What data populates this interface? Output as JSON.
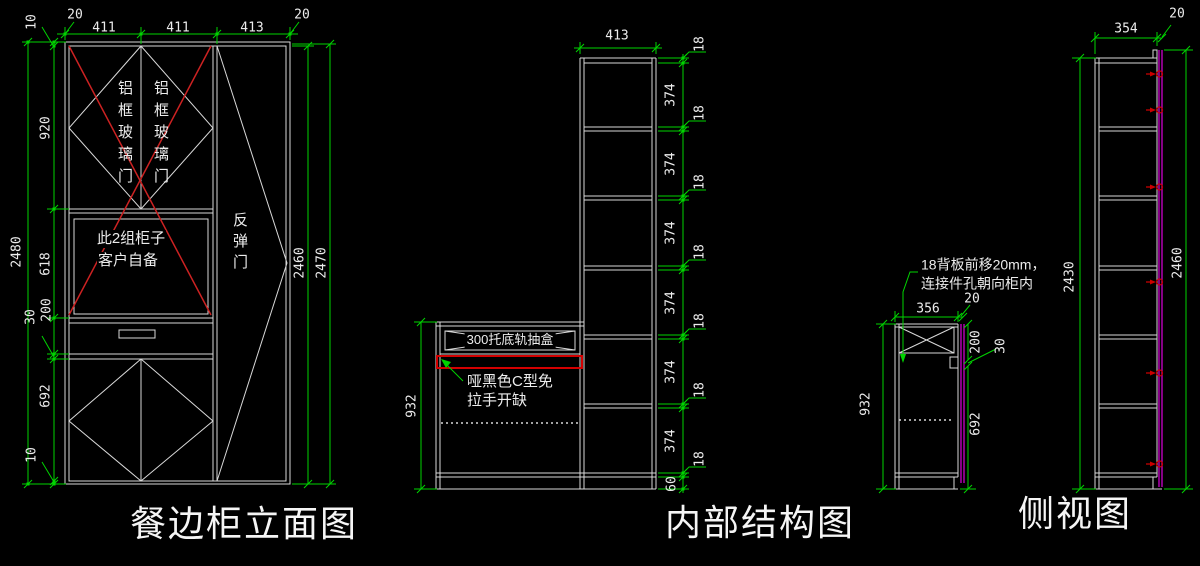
{
  "colors": {
    "background": "#000000",
    "line": "#d9d9d9",
    "dimension": "#00d400",
    "highlight_red": "#d40000",
    "back_panel_magenta": "#dd00dd",
    "text": "#ececec"
  },
  "elevation": {
    "title": "餐边柜立面图",
    "top_dims": {
      "left_gap": "20",
      "col1": "411",
      "col2": "411",
      "col3": "413",
      "right_gap": "20"
    },
    "left_dims": {
      "total": "2480",
      "top_panel": "10",
      "glass": "920",
      "middle": "618",
      "drawer": "200",
      "strip": "30",
      "bottom_door": "692",
      "bottom_panel": "10"
    },
    "right_dims": {
      "inner": "2460",
      "outer": "2470"
    },
    "glass_door_label": "铝框玻璃门",
    "middle_note_line1": "此2组柜子",
    "middle_note_line2": "客户自备",
    "spring_door_label": "反弹门"
  },
  "internal": {
    "title": "内部结构图",
    "top_dim": "413",
    "left_dim": "932",
    "right_chain": [
      "18",
      "374",
      "18",
      "374",
      "18",
      "374",
      "18",
      "374",
      "18",
      "374",
      "18",
      "374",
      "18",
      "60"
    ],
    "drawer_box_label": "300托底轨抽盒",
    "handle_note_line1": "哑黑色C型免",
    "handle_note_line2": "拉手开缺"
  },
  "side_detail": {
    "note_line1": "18背板前移20mm，",
    "note_line2": "连接件孔朝向柜内",
    "top_dim": "356",
    "back_gap_dim": "20",
    "left_dim": "932",
    "right_dims": {
      "drawer": "200",
      "notch": "30",
      "door": "692"
    }
  },
  "side_view": {
    "title": "侧视图",
    "top_dim": "354",
    "back_gap_dim": "20",
    "left_dim": "2430",
    "right_dim": "2460"
  }
}
